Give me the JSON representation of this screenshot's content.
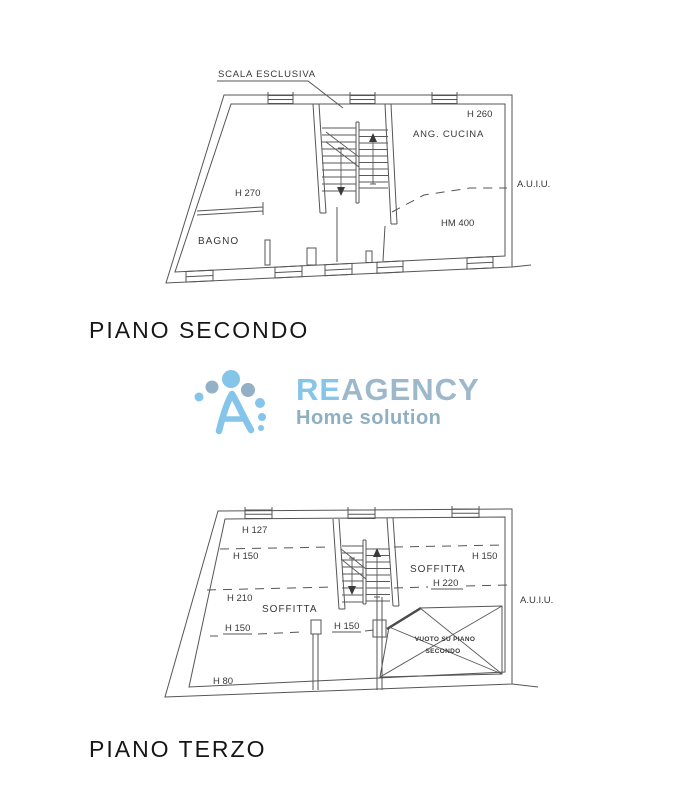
{
  "page": {
    "background": "#ffffff"
  },
  "logo": {
    "re": "RE",
    "agency": "AGENCY",
    "tagline": "Home solution",
    "icon": "person-a-dots-icon",
    "colors": {
      "light_blue": "#85C5E9",
      "gray_blue": "#92B1C6",
      "wordmark_gray": "#9DB8CB"
    }
  },
  "plan_secondo": {
    "title": "PIANO SECONDO",
    "labels": {
      "scala_esclusiva": "SCALA ESCLUSIVA",
      "h260": "H 260",
      "ang_cucina": "ANG. CUCINA",
      "auiu": "A.U.I.U.",
      "h270": "H 270",
      "hm400": "HM 400",
      "bagno": "BAGNO"
    }
  },
  "plan_terzo": {
    "title": "PIANO TERZO",
    "labels": {
      "h127": "H 127",
      "h150_top_left": "H 150",
      "h150_top_right": "H 150",
      "soffitta_right": "SOFFITTA",
      "h220": "H 220",
      "h210": "H 210",
      "soffitta_left": "SOFFITTA",
      "h150_mid_left": "H 150",
      "h150_mid_center": "H 150",
      "vuoto_line1": "VUOTO SU PIANO",
      "vuoto_line2": "SECONDO",
      "h80": "H 80",
      "auiu": "A.U.I.U."
    }
  }
}
